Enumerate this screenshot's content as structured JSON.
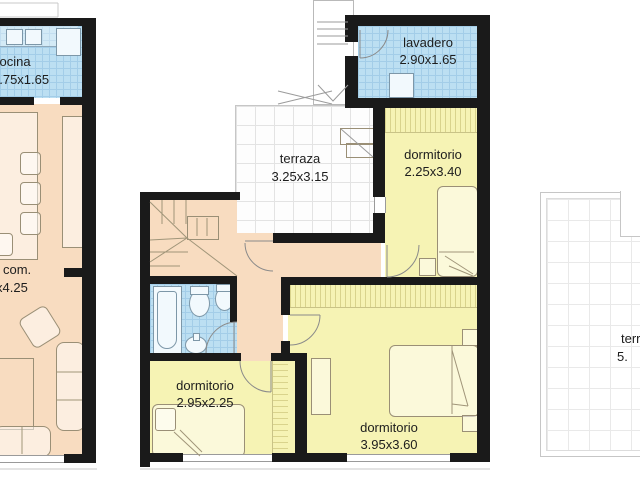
{
  "title": "floor-plan",
  "plans": {
    "left": {
      "kitchen": {
        "label": "cocina",
        "dims": "1.75x1.65"
      },
      "living": {
        "label": "com.",
        "dims": "x4.25"
      }
    },
    "middle": {
      "laundry": {
        "label": "lavadero",
        "dims": "2.90x1.65"
      },
      "terrace": {
        "label": "terraza",
        "dims": "3.25x3.15"
      },
      "bedroom1": {
        "label": "dormitorio",
        "dims": "2.25x3.40"
      },
      "bedroom2": {
        "label": "dormitorio",
        "dims": "2.95x2.25"
      },
      "bedroom3": {
        "label": "dormitorio",
        "dims": "3.95x3.60"
      }
    },
    "right": {
      "terrace": {
        "label": "terraza",
        "dims": "5."
      }
    }
  },
  "colors": {
    "wall": "#1a1a1a",
    "floor_main": "#f8dcc0",
    "floor_room": "#f6f3b4",
    "floor_wet": "#bcdff2",
    "tile_line": "#a3cde8",
    "outline": "#9a8f76",
    "terrace_line": "#c6c6c6",
    "text": "#1d1d1d"
  }
}
